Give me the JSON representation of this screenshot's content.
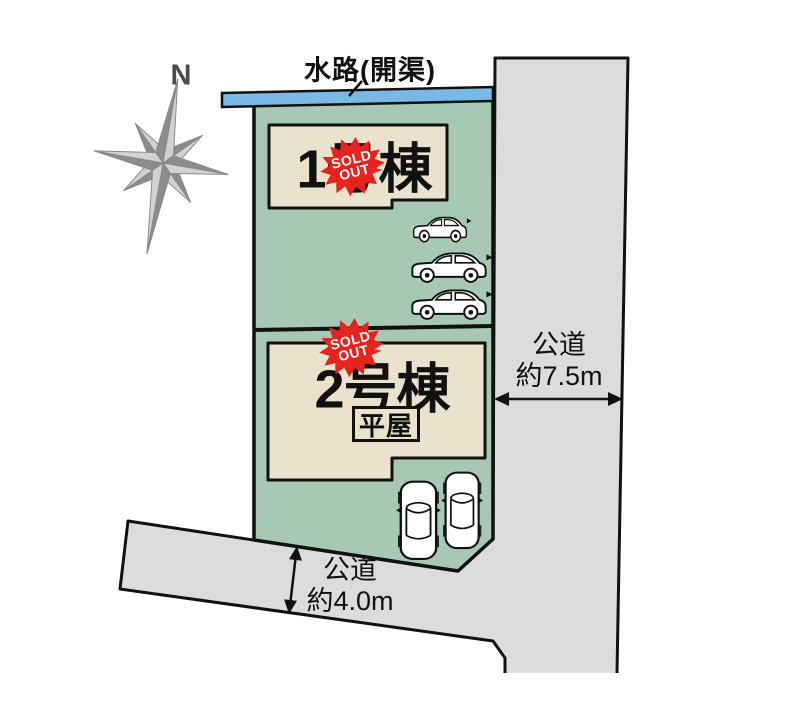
{
  "title": "区画図",
  "compass": {
    "north_label": "N"
  },
  "waterway": {
    "label": "水路(開渠)",
    "color": "#7ab8e8"
  },
  "plot": {
    "fill": "#a6c8b5"
  },
  "lot1": {
    "name": "1号棟",
    "sold_badge": {
      "line1": "SOLD",
      "line2": "OUT"
    }
  },
  "lot2": {
    "name": "2号棟",
    "type_label": "平屋",
    "sold_badge": {
      "line1": "SOLD",
      "line2": "OUT"
    }
  },
  "roads": {
    "right": {
      "name": "公道",
      "width": "約7.5m"
    },
    "bottom": {
      "name": "公道",
      "width": "約4.0m"
    },
    "color": "#dcdcdc"
  },
  "buildings": {
    "fill": "#eae2cd",
    "count": 2
  },
  "cars": {
    "top_lot_count": 3,
    "bottom_lot_count": 2
  },
  "badge_color": "#e6231d"
}
